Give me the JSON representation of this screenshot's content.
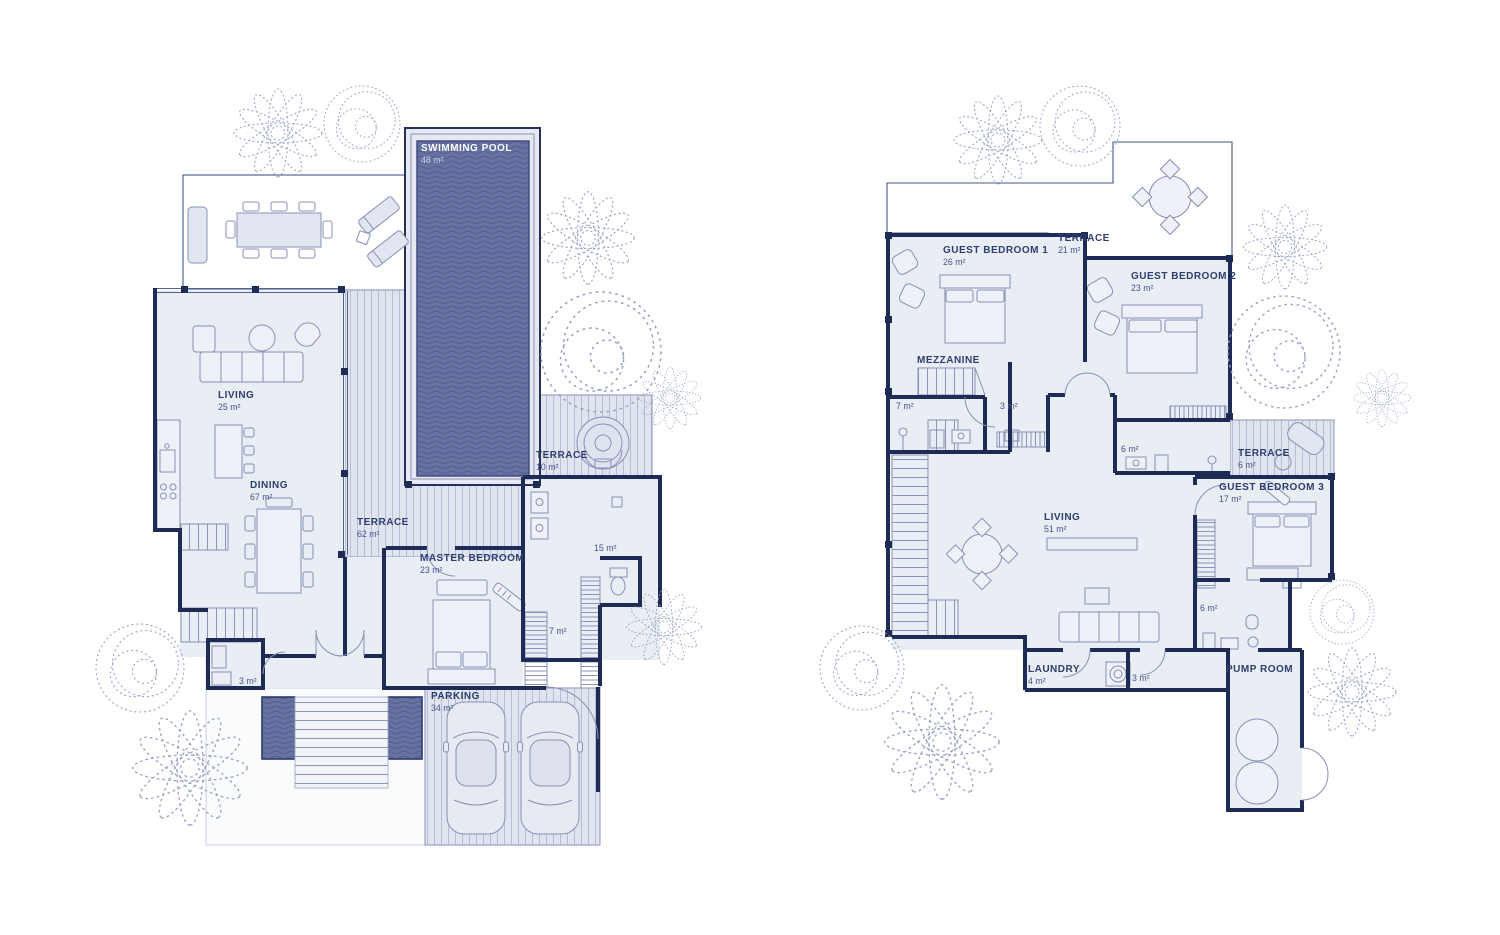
{
  "colors": {
    "wall": "#1e2b55",
    "room_fill": "#e9edf4",
    "deck_fill": "#e0e4ef",
    "pool_fill": "#6672a2",
    "label_text": "#2e3d6e",
    "area_text": "#47548a",
    "tree_stroke": "#97a1c2",
    "pool_label_text": "#ffffff"
  },
  "left_plan": {
    "labels": [
      {
        "id": "swimming-pool",
        "name": "SWIMMING POOL",
        "area": "48 m²"
      },
      {
        "id": "living",
        "name": "LIVING",
        "area": "25 m²"
      },
      {
        "id": "dining",
        "name": "DINING",
        "area": "67 m²"
      },
      {
        "id": "terrace-62",
        "name": "TERRACE",
        "area": "62 m²"
      },
      {
        "id": "terrace-10",
        "name": "TERRACE",
        "area": "10 m²"
      },
      {
        "id": "master-bedroom",
        "name": "MASTER BEDROOM",
        "area": "23 m²"
      },
      {
        "id": "bathroom-15",
        "name": "",
        "area": "15 m²"
      },
      {
        "id": "wardrobe-7",
        "name": "",
        "area": "7 m²"
      },
      {
        "id": "wc-3",
        "name": "",
        "area": "3 m²"
      },
      {
        "id": "parking",
        "name": "PARKING",
        "area": "34 m²"
      }
    ]
  },
  "right_plan": {
    "labels": [
      {
        "id": "guest-bedroom-1",
        "name": "GUEST BEDROOM 1",
        "area": "26 m²"
      },
      {
        "id": "terrace-21",
        "name": "TERRACE",
        "area": "21 m²"
      },
      {
        "id": "guest-bedroom-2",
        "name": "GUEST BEDROOM 2",
        "area": "23 m²"
      },
      {
        "id": "mezzanine",
        "name": "MEZZANINE",
        "area": ""
      },
      {
        "id": "bath-7",
        "name": "",
        "area": "7 m²"
      },
      {
        "id": "wc-3",
        "name": "",
        "area": "3 m²"
      },
      {
        "id": "bath-6",
        "name": "",
        "area": "6 m²"
      },
      {
        "id": "terrace-6",
        "name": "TERRACE",
        "area": "6 m²"
      },
      {
        "id": "guest-bedroom-3",
        "name": "GUEST BEDROOM 3",
        "area": "17 m²"
      },
      {
        "id": "living",
        "name": "LIVING",
        "area": "51 m²"
      },
      {
        "id": "bath-6b",
        "name": "",
        "area": "6 m²"
      },
      {
        "id": "laundry",
        "name": "LAUNDRY",
        "area": "4 m²"
      },
      {
        "id": "wc-3b",
        "name": "",
        "area": "3 m²"
      },
      {
        "id": "pump-room",
        "name": "PUMP ROOM",
        "area": ""
      }
    ]
  }
}
